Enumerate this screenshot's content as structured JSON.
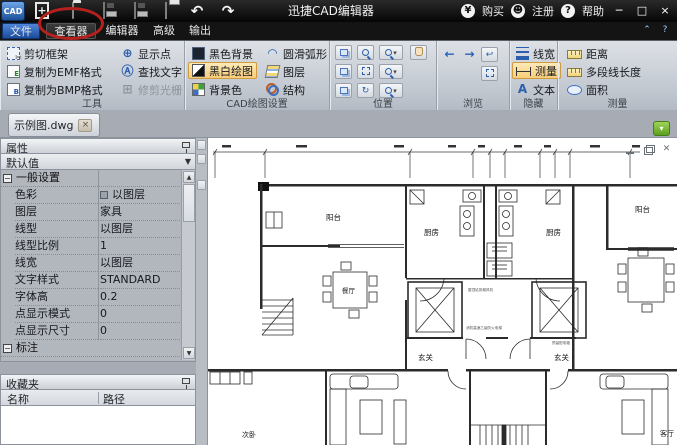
{
  "titlebar": {
    "app_title": "迅捷CAD编辑器",
    "buy": "购买",
    "register": "注册",
    "help": "帮助",
    "minimize_glyph": "─",
    "maximize_glyph": "□",
    "close_glyph": "×",
    "yen_glyph": "¥",
    "question_glyph": "?"
  },
  "menu_tabs": {
    "file": "文件",
    "viewer": "查看器",
    "editor": "编辑器",
    "advanced": "高级",
    "output": "输出"
  },
  "ribbon": {
    "tools": {
      "caption": "工具",
      "cut_frame": "剪切框架",
      "copy_emf": "复制为EMF格式",
      "copy_bmp": "复制为BMP格式",
      "show_points": "显示点",
      "find_text": "查找文字",
      "trim_raster": "修剪光栅"
    },
    "cad_draw": {
      "caption": "CAD绘图设置",
      "black_bg": "黑色背景",
      "bw_draw": "黑白绘图",
      "bg_color": "背景色",
      "smooth_arc": "圆滑弧形",
      "layers": "图层",
      "structure": "结构"
    },
    "position": {
      "caption": "位置"
    },
    "browse": {
      "caption": "浏览"
    },
    "hide": {
      "caption": "隐藏",
      "line_width": "线宽",
      "measure": "测量",
      "text": "文本",
      "text_icon": "A"
    },
    "measure": {
      "caption": "测量",
      "distance": "距离",
      "polyline_length": "多段线长度",
      "area": "面积"
    }
  },
  "doc": {
    "tab_title": "示例图.dwg",
    "close_glyph": "×"
  },
  "properties": {
    "title": "属性",
    "preset": "默认值",
    "section_general": "一般设置",
    "section_dimension": "标注",
    "rows": [
      {
        "label": "色彩",
        "value": "以图层"
      },
      {
        "label": "图层",
        "value": "家具"
      },
      {
        "label": "线型",
        "value": "以图层"
      },
      {
        "label": "线型比例",
        "value": "1"
      },
      {
        "label": "线宽",
        "value": "以图层"
      },
      {
        "label": "文字样式",
        "value": "STANDARD"
      },
      {
        "label": "字体高",
        "value": "0.2"
      },
      {
        "label": "点显示模式",
        "value": "0"
      },
      {
        "label": "点显示尺寸",
        "value": "0"
      }
    ]
  },
  "favorites": {
    "title": "收藏夹",
    "col_name": "名称",
    "col_path": "路径"
  },
  "drawing": {
    "rooms": {
      "balcony_left": "阳台",
      "kitchen_left": "厨房",
      "kitchen_right": "厨房",
      "balcony_right": "阳台",
      "dining": "餐厅",
      "entry_left": "玄关",
      "entry_right": "玄关",
      "bedroom2": "次卧",
      "living_right": "客厅"
    },
    "annotations": {
      "note1": "屋顶给排烟风机",
      "note2": "消防高速乙级防火电梯",
      "note3": "预留配电箱"
    }
  },
  "colors": {
    "accent_blue": "#2f66b3",
    "highlight_orange": "#f8cd7a",
    "annotation_red": "#b5211c"
  }
}
